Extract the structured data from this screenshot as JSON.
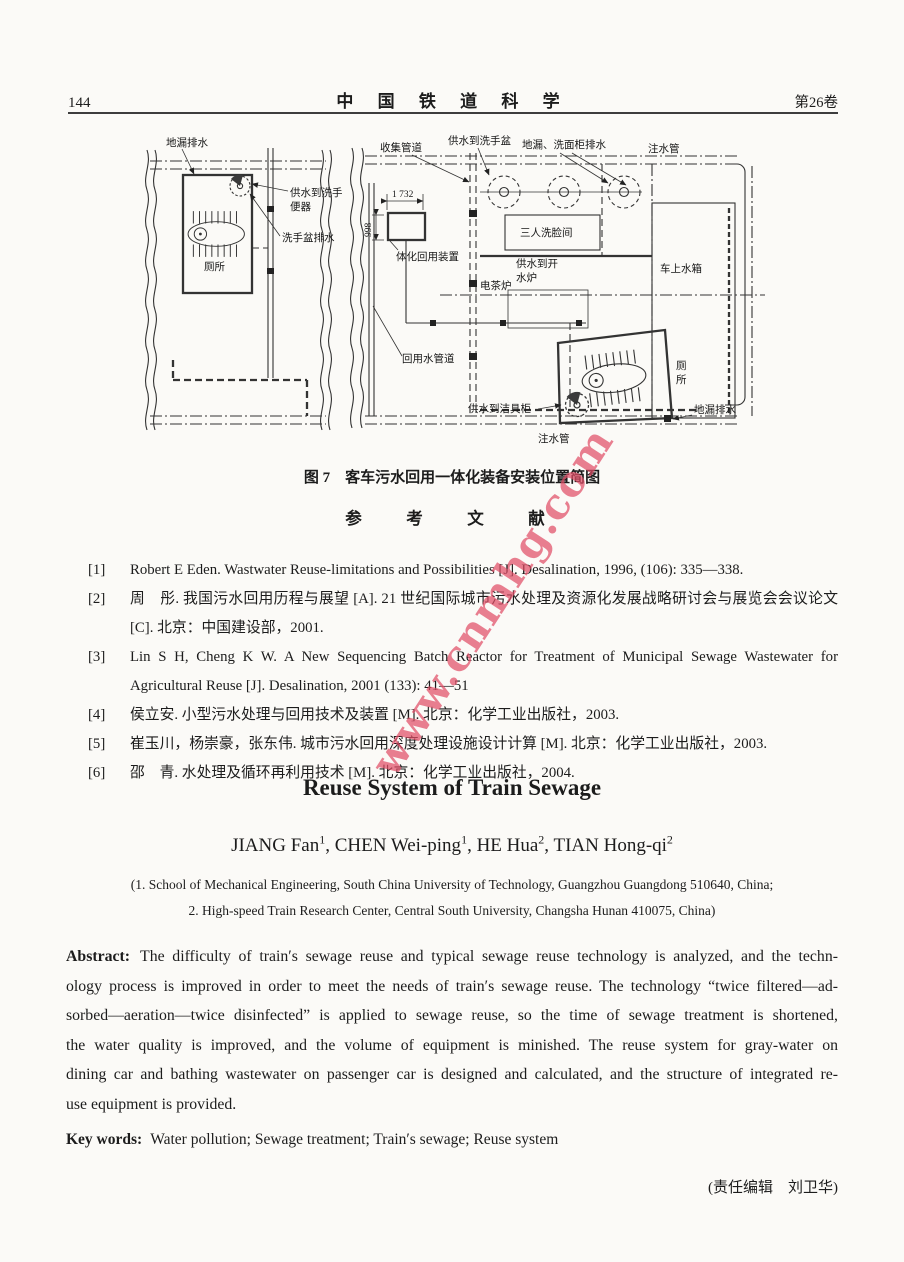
{
  "header": {
    "page_number": "144",
    "journal_title": "中 国 铁 道 科 学",
    "volume": "第26卷"
  },
  "watermark": {
    "text": "www.cnmhg.com",
    "color": "#e04d66"
  },
  "figure": {
    "caption": "图 7　客车污水回用一体化装备安装位置简图",
    "labels": {
      "left_floor_drain": "地漏排水",
      "left_supply_line1": "供水到洗手",
      "left_supply_line2": "便器",
      "left_basin_drain": "洗手盆排水",
      "left_toilet": "厕所",
      "collection_pipe": "收集管道",
      "supply_washbasin": "供水到洗手盆",
      "drain_cabinet": "地漏、洗面柜排水",
      "filling_pipe_top": "注水管",
      "dim_width": "1 732",
      "dim_height": "998",
      "integrated_unit": "体化回用装置",
      "washing_room": "三人洗脸间",
      "supply_boiler_line1": "供水到开",
      "supply_boiler_line2": "水炉",
      "tea_stove": "电茶炉",
      "water_tank": "车上水箱",
      "reuse_pipe": "回用水管道",
      "supply_sanitary": "供水到洁具柜",
      "right_toilet_char1": "厕",
      "right_toilet_char2": "所",
      "right_floor_drain": "地漏排水",
      "filling_pipe_bottom": "注水管"
    }
  },
  "references": {
    "heading": "参　考　文　献",
    "items": [
      {
        "num": "[1]",
        "text": "Robert E Eden. Wastwater Reuse-limitations and Possibilities [J]. Desalination, 1996, (106): 335—338."
      },
      {
        "num": "[2]",
        "text": "周　彤. 我国污水回用历程与展望 [A]. 21 世纪国际城市污水处理及资源化发展战略研讨会与展览会会议论文 [C]. 北京：中国建设部，2001."
      },
      {
        "num": "[3]",
        "text": "Lin S H, Cheng K W. A New Sequencing Batch Reactor for Treatment of Municipal Sewage Wastewater for Agricultural Reuse [J]. Desalination, 2001 (133): 41—51"
      },
      {
        "num": "[4]",
        "text": "侯立安. 小型污水处理与回用技术及装置 [M]. 北京：化学工业出版社，2003."
      },
      {
        "num": "[5]",
        "text": "崔玉川，杨崇豪，张东伟. 城市污水回用深度处理设施设计计算 [M]. 北京：化学工业出版社，2003."
      },
      {
        "num": "[6]",
        "text": "邵　青. 水处理及循环再利用技术 [M]. 北京：化学工业出版社，2004."
      }
    ]
  },
  "article": {
    "title": "Reuse System of Train Sewage",
    "authors": [
      {
        "name": "JIANG Fan",
        "sup": "1",
        "sep": ", "
      },
      {
        "name": "CHEN Wei-ping",
        "sup": "1",
        "sep": ", "
      },
      {
        "name": "HE Hua",
        "sup": "2",
        "sep": ", "
      },
      {
        "name": "TIAN Hong-qi",
        "sup": "2",
        "sep": ""
      }
    ],
    "affiliation_line1": "(1. School of Mechanical Engineering, South China University of Technology, Guangzhou Guangdong  510640, China;",
    "affiliation_line2": "2. High-speed Train Research Center, Central South University, Changsha Hunan  410075, China)",
    "abstract_label": "Abstract:",
    "abstract_lines": [
      "The difficulty of train′s sewage reuse and typical sewage reuse technology is analyzed, and the techn-",
      "ology process is improved in order to meet the needs of train′s sewage reuse.  The technology “twice filtered—ad-",
      "sorbed—aeration—twice disinfected” is applied to sewage reuse, so the time of sewage treatment is shortened,",
      "the water quality is improved, and the volume of equipment is minished.  The reuse system for gray-water on",
      "dining car and bathing wastewater on passenger car is designed and calculated, and the structure of integrated re-",
      "use equipment is provided."
    ],
    "keywords_label": "Key words:",
    "keywords_text": "Water pollution; Sewage treatment; Train′s sewage; Reuse system"
  },
  "footer": {
    "editor_note": "(责任编辑　刘卫华)"
  }
}
